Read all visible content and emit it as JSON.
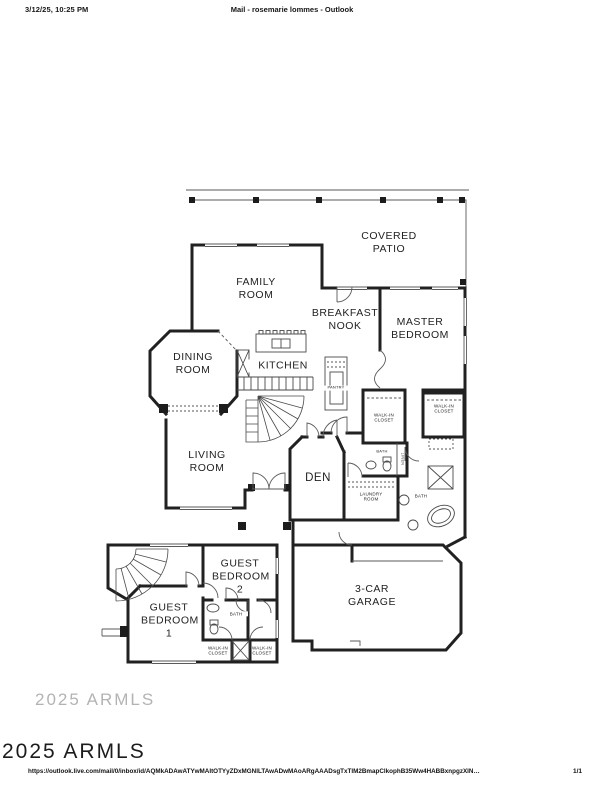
{
  "header": {
    "datetime": "3/12/25, 10:25 PM",
    "title": "Mail - rosemarie lommes - Outlook"
  },
  "watermark": {
    "top": "2025 ARMLS",
    "bottom": "2025 ARMLS"
  },
  "footer": {
    "url": "https://outlook.live.com/mail/0/inbox/id/AQMkADAwATYwMAItOTYyZDxMGNlLTAwADwMAoARgAAADsgTxTlM2BmapClkophB35Ww4HABBxnpgzXlN…",
    "page": "1/1"
  },
  "floorplan": {
    "covered_patio": "COVERED PATIO",
    "family_room": "FAMILY ROOM",
    "breakfast_nook": "BREAKFAST NOOK",
    "master_bedroom": "MASTER BEDROOM",
    "dining_room": "DINING ROOM",
    "kitchen": "KITCHEN",
    "pantry": "PANTRY",
    "walk_in_closet_master": "WALK-IN CLOSET",
    "walk_in_closet_2": "WALK-IN CLOSET",
    "living_room": "LIVING ROOM",
    "den": "DEN",
    "bath_powder": "BATH",
    "linen": "LINEN",
    "laundry_room": "LAUNDRY ROOM",
    "bath_master": "BATH",
    "guest_bedroom_2": "GUEST BEDROOM 2",
    "guest_bedroom_1": "GUEST BEDROOM 1",
    "bath_guest": "BATH",
    "walk_in_closet_g1": "WALK-IN CLOSET",
    "walk_in_closet_g2": "WALK-IN CLOSET",
    "garage": "3-CAR GARAGE"
  }
}
